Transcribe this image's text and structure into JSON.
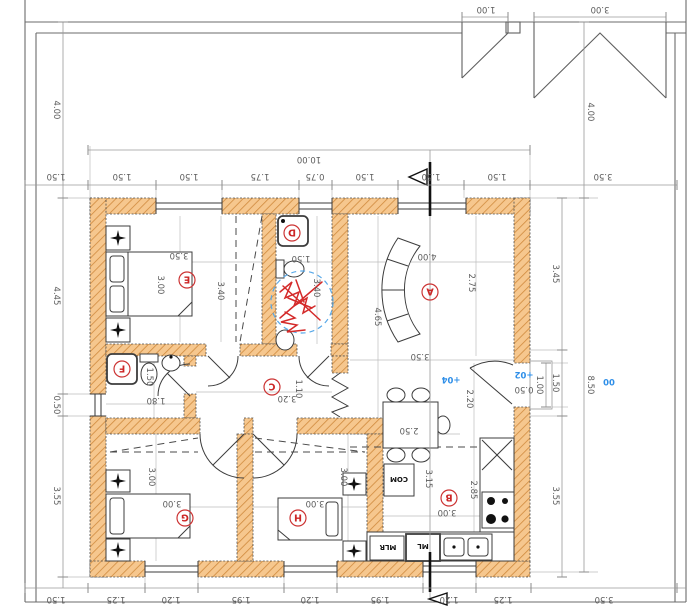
{
  "levels": {
    "step": "+02",
    "floor": "+04",
    "site": "00"
  },
  "entry": {
    "door_width": "1.00",
    "step_depth": "0.50"
  },
  "dining": {
    "table_width": "2.50",
    "door_diag": "2.20"
  },
  "kitchen": {
    "com": "COM",
    "mlr": "MLR",
    "ml": "ML"
  },
  "rooms": {
    "A": {
      "label": "A",
      "dims": [
        "4.00",
        "2.75",
        "4.65",
        "3.50"
      ]
    },
    "B": {
      "label": "B",
      "dims": [
        "3.15",
        "2.85",
        "3.00"
      ]
    },
    "C": {
      "label": "C",
      "dims": [
        "3.20",
        "1.10"
      ]
    },
    "D": {
      "label": "D",
      "dims": [
        "1.50",
        "3.40"
      ]
    },
    "E": {
      "label": "E",
      "dims": [
        "3.50",
        "3.00",
        "3.40"
      ]
    },
    "F": {
      "label": "F",
      "dims": [
        "1.50",
        "1.80"
      ]
    },
    "G": {
      "label": "G",
      "dims": [
        "3.00",
        "3.00"
      ]
    },
    "H": {
      "label": "H",
      "dims": [
        "3.00",
        "3.00"
      ]
    }
  },
  "dims": {
    "total_width": "10.00",
    "top_row": [
      "1.50",
      "1.50",
      "1.50",
      "1.75",
      "0.75",
      "1.50",
      "1.50",
      "1.50",
      "3.50"
    ],
    "bottom_row": [
      "1.50",
      "1.25",
      "1.20",
      "1.95",
      "1.20",
      "1.95",
      "1.20",
      "1.25",
      "3.50"
    ],
    "left_col": [
      "4.00",
      "4.45",
      "0.50",
      "3.55"
    ],
    "right_col": [
      "4.00",
      "3.45",
      "1.50",
      "3.55",
      "8.50"
    ],
    "roof": {
      "small": "1.00",
      "large": "3.00"
    }
  }
}
